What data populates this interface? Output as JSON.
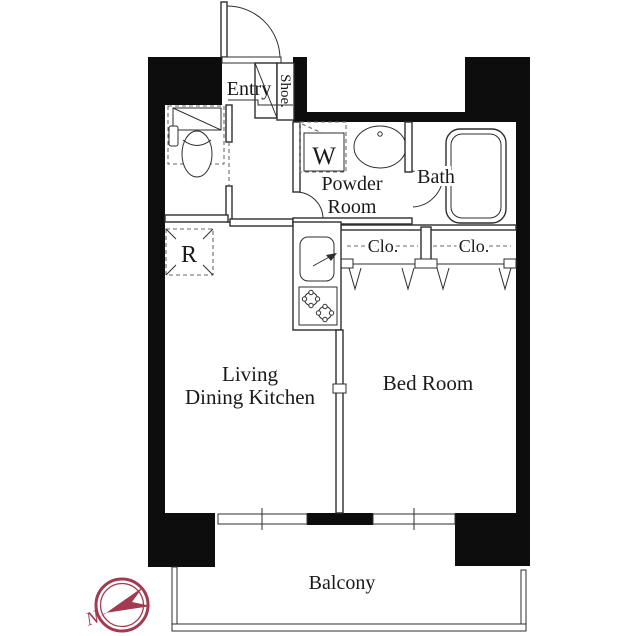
{
  "colors": {
    "background": "#ffffff",
    "wall": "#0d0d0d",
    "line": "#2e2e2e",
    "dash": "#6a6a6a",
    "text": "#1a1a1a",
    "accent": "#a23a50"
  },
  "floorplan": {
    "labels": {
      "entry": "Entry",
      "shoe": "Shoe.",
      "washer": "W",
      "powder_line1": "Powder",
      "powder_line2": "Room",
      "bath": "Bath",
      "closet_left": "Clo.",
      "closet_right": "Clo.",
      "refrigerator": "R",
      "ldk_line1": "Living",
      "ldk_line2": "Dining Kitchen",
      "bedroom": "Bed Room",
      "balcony": "Balcony"
    },
    "compass": {
      "north": "N"
    }
  }
}
